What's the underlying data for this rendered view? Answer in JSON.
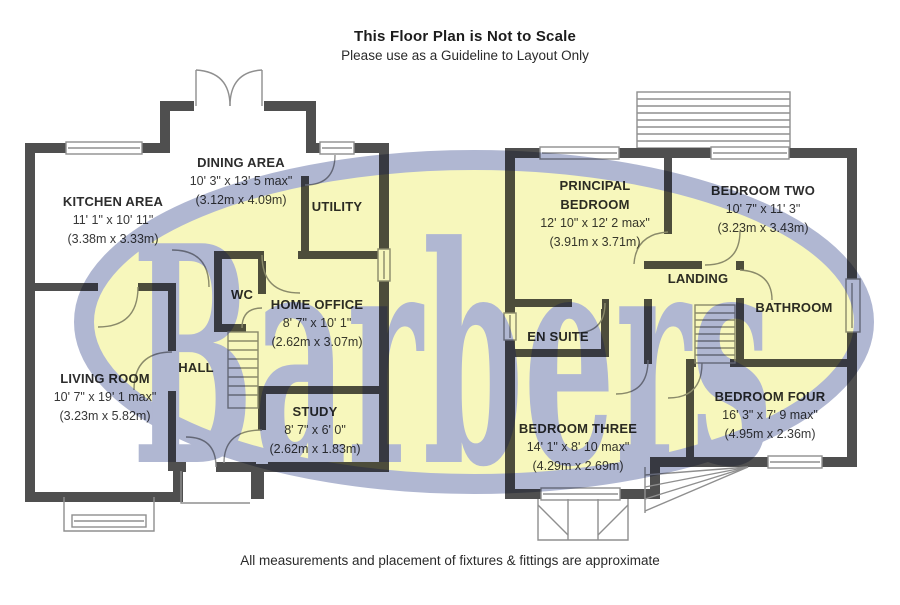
{
  "header": {
    "title": "This Floor Plan is Not to Scale",
    "subtitle": "Please use as a Guideline to Layout Only"
  },
  "footer": {
    "note": "All measurements and placement of fixtures & fittings are approximate"
  },
  "watermark": {
    "text": "Barbers",
    "fill_color": "#f7f7bc",
    "accent_color": "#b0b7d2"
  },
  "colors": {
    "wall": "#4f4f4f",
    "thin_line": "#8f8f8f",
    "label_text": "#2d2d2d"
  },
  "ground_floor": {
    "rooms": {
      "kitchen_area": {
        "label": "KITCHEN AREA",
        "size_ft": "11' 1\" x 10' 11\"",
        "size_m": "(3.38m x 3.33m)"
      },
      "dining_area": {
        "label": "DINING AREA",
        "size_ft": "10' 3\" x 13' 5 max\"",
        "size_m": "(3.12m x 4.09m)"
      },
      "utility": {
        "label": "UTILITY"
      },
      "wc": {
        "label": "WC"
      },
      "home_office": {
        "label": "HOME OFFICE",
        "size_ft": "8' 7\" x 10' 1\"",
        "size_m": "(2.62m x 3.07m)"
      },
      "hall": {
        "label": "HALL"
      },
      "living_room": {
        "label": "LIVING ROOM",
        "size_ft": "10' 7\" x 19' 1 max\"",
        "size_m": "(3.23m x 5.82m)"
      },
      "study": {
        "label": "STUDY",
        "size_ft": "8' 7\" x 6' 0\"",
        "size_m": "(2.62m x 1.83m)"
      }
    }
  },
  "first_floor": {
    "rooms": {
      "principal_bedroom": {
        "label": "PRINCIPAL BEDROOM",
        "size_ft": "12' 10\" x 12' 2 max\"",
        "size_m": "(3.91m x 3.71m)"
      },
      "bedroom_two": {
        "label": "BEDROOM TWO",
        "size_ft": "10' 7\" x 11' 3\"",
        "size_m": "(3.23m x 3.43m)"
      },
      "landing": {
        "label": "LANDING"
      },
      "bathroom": {
        "label": "BATHROOM"
      },
      "en_suite": {
        "label": "EN SUITE"
      },
      "bedroom_three": {
        "label": "BEDROOM THREE",
        "size_ft": "14' 1\" x 8' 10 max\"",
        "size_m": "(4.29m x 2.69m)"
      },
      "bedroom_four": {
        "label": "BEDROOM FOUR",
        "size_ft": "16' 3\" x 7' 9 max\"",
        "size_m": "(4.95m x 2.36m)"
      }
    }
  }
}
